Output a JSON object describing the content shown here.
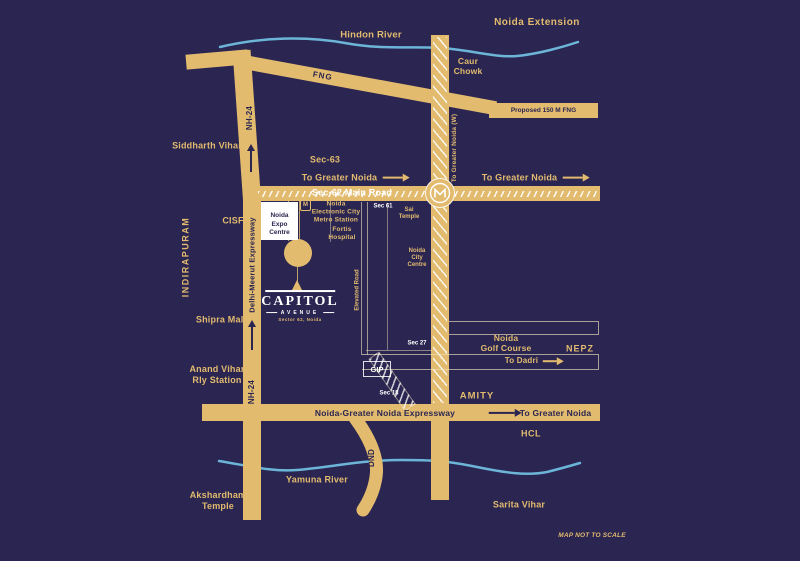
{
  "title": "Capitol Avenue Noida location map",
  "colors": {
    "background": "#2a2551",
    "road": "#e2bb6f",
    "river": "#6cb5d9",
    "label_gold": "#e2bb6f",
    "label_dark": "#2a2551",
    "label_white": "#ffffff"
  },
  "logo": {
    "name": "CAPITOL",
    "sub": "AVENUE",
    "tagline": "Sector 62, Noida"
  },
  "labels": {
    "noida_extension": "Noida Extension",
    "hindon_river": "Hindon River",
    "caur_chowk": "Caur\nChowk",
    "fng": "FNG",
    "proposed_fng": "Proposed 150 M FNG",
    "nh24": "NH-24",
    "siddharth_vihar": "Siddharth Vihar",
    "sec63": "Sec-63",
    "to_greater_noida": "To Greater Noida",
    "to_greater_noida_w": "To Greater Noida (W)",
    "sec62_main_road": "Sec-62 Main Road",
    "indirapuram": "INDIRAPURAM",
    "cisf": "CISF",
    "delhi_meerut_expressway": "Delhi-Meerut Expressway",
    "noida_expo_centre": "Noida\nExpo\nCentre",
    "metro_icon": "M",
    "metro_station": "Noida\nElectronic City\nMetro Station",
    "fortis_hospital": "Fortis\nHospital",
    "sec61": "Sec 61",
    "sai_temple": "Sai\nTemple",
    "noida_city_centre": "Noida\nCity\nCentre",
    "shipra_mall": "Shipra Mall",
    "elevated_road": "Elevated Road",
    "sec27": "Sec 27",
    "noida_golf_course": "Noida\nGolf Course",
    "nepz": "NEPZ",
    "to_dadri": "To Dadri",
    "gip": "GIP",
    "sec18": "Sec 18",
    "anand_vihar": "Anand Vihar\nRly Station",
    "amity": "AMITY",
    "noida_greater_noida_expressway": "Noida-Greater Noida Expressway",
    "hcl": "HCL",
    "dnd": "DND",
    "yamuna_river": "Yamuna River",
    "akshardham": "Akshardham\nTemple",
    "sarita_vihar": "Sarita Vihar",
    "map_not_to_scale": "MAP NOT TO SCALE"
  }
}
